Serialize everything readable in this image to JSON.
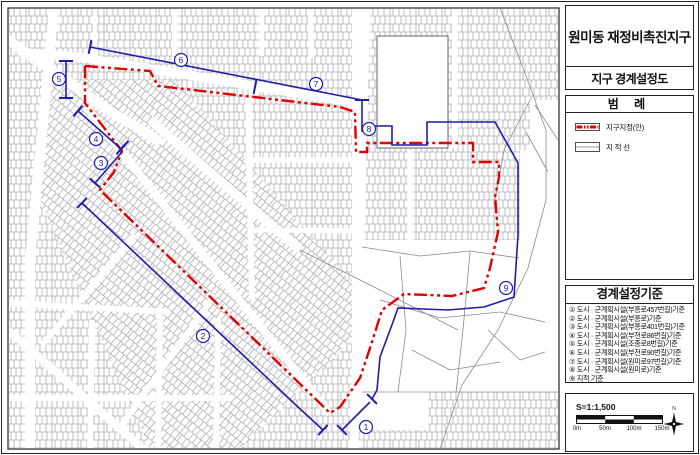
{
  "panel": {
    "title": "원미동 재정비촉진지구",
    "subtitle": "지구 경계설정도",
    "legend_title": "범 례",
    "legend_items": [
      {
        "label": "지구지정(안)",
        "type": "district-line"
      },
      {
        "label": "지 적 선",
        "type": "cadastral-line"
      }
    ]
  },
  "criteria": {
    "title": "경계설정기준",
    "items": [
      "① 도시 · 군계획시설(부흥로457번길)기준",
      "② 도시 · 군계획시설(부흥로)기준",
      "③ 도시 · 군계획시설(부흥로401번길)기준",
      "④ 도시 · 군계획시설(부천로86번길)기준",
      "⑤ 도시 · 군계획시설(조종로8번길)기준",
      "⑥ 도시 · 군계획시설(부천로90번길)기준",
      "⑦ 도시 · 군계획시설(원미로97번길)기준",
      "⑧ 도시 · 군계획시설(원미로)기준",
      "⑨ 지적 기준"
    ]
  },
  "scalebar": {
    "label": "S=1:1,500",
    "ticks": [
      "0m",
      "50m",
      "100m",
      "150m"
    ],
    "compass": "N"
  },
  "map": {
    "colors": {
      "district": "#e10000",
      "annotation": "#1d1daa",
      "parcel": "#8a8a96"
    },
    "red_boundary": [
      [
        85,
        66
      ],
      [
        150,
        71
      ],
      [
        158,
        86
      ],
      [
        340,
        107
      ],
      [
        355,
        112
      ],
      [
        356,
        152
      ],
      [
        367,
        152
      ],
      [
        367,
        143
      ],
      [
        473,
        143
      ],
      [
        473,
        162
      ],
      [
        499,
        162
      ],
      [
        499,
        177
      ],
      [
        495,
        197
      ],
      [
        498,
        232
      ],
      [
        490,
        268
      ],
      [
        484,
        288
      ],
      [
        452,
        296
      ],
      [
        404,
        294
      ],
      [
        382,
        310
      ],
      [
        372,
        342
      ],
      [
        360,
        378
      ],
      [
        340,
        407
      ],
      [
        330,
        413
      ],
      [
        100,
        190
      ],
      [
        114,
        172
      ],
      [
        122,
        151
      ],
      [
        85,
        103
      ],
      [
        85,
        66
      ]
    ],
    "blue_segments": [
      [
        [
          90,
          47
        ],
        [
          362,
          100
        ]
      ],
      [
        [
          66,
          61
        ],
        [
          66,
          98
        ]
      ],
      [
        [
          362,
          100
        ],
        [
          362,
          131
        ],
        [
          373,
          131
        ],
        [
          373,
          126
        ],
        [
          392,
          126
        ],
        [
          392,
          145
        ],
        [
          427,
          145
        ],
        [
          427,
          122
        ],
        [
          495,
          122
        ],
        [
          518,
          163
        ],
        [
          518,
          235
        ],
        [
          514,
          297
        ],
        [
          484,
          307
        ],
        [
          448,
          310
        ],
        [
          398,
          308
        ],
        [
          393,
          322
        ],
        [
          380,
          357
        ],
        [
          377,
          390
        ],
        [
          372,
          399
        ]
      ],
      [
        [
          370,
          402
        ],
        [
          342,
          430
        ]
      ],
      [
        [
          82,
          203
        ],
        [
          298,
          407
        ],
        [
          323,
          430
        ]
      ],
      [
        [
          78,
          111
        ],
        [
          120,
          148
        ]
      ],
      [
        [
          122,
          152
        ],
        [
          95,
          183
        ]
      ]
    ],
    "ticks": [
      [
        66,
        61,
        0
      ],
      [
        66,
        98,
        0
      ],
      [
        90,
        47,
        101
      ],
      [
        255,
        87,
        101
      ],
      [
        362,
        100,
        0
      ],
      [
        372,
        399,
        45
      ],
      [
        342,
        430,
        45
      ],
      [
        82,
        203,
        134
      ],
      [
        323,
        430,
        133
      ],
      [
        78,
        111,
        131
      ],
      [
        121,
        149,
        131
      ],
      [
        124,
        146,
        131
      ],
      [
        95,
        183,
        41
      ]
    ],
    "markers": [
      {
        "n": "1",
        "x": 366,
        "y": 427
      },
      {
        "n": "2",
        "x": 203,
        "y": 336
      },
      {
        "n": "3",
        "x": 101,
        "y": 163
      },
      {
        "n": "4",
        "x": 96,
        "y": 139
      },
      {
        "n": "5",
        "x": 59,
        "y": 79
      },
      {
        "n": "6",
        "x": 181,
        "y": 60
      },
      {
        "n": "7",
        "x": 316,
        "y": 84
      },
      {
        "n": "8",
        "x": 369,
        "y": 129
      },
      {
        "n": "9",
        "x": 506,
        "y": 288
      }
    ],
    "roads": [
      {
        "pts": [
          [
            54,
            8
          ],
          [
            30,
            260
          ],
          [
            30,
            449
          ]
        ],
        "w": 10
      },
      {
        "pts": [
          [
            366,
            8
          ],
          [
            354,
            449
          ]
        ],
        "w": 9
      },
      {
        "pts": [
          [
            20,
            52
          ],
          [
            85,
            58
          ],
          [
            362,
            104
          ]
        ],
        "w": 9
      },
      {
        "pts": [
          [
            86,
            107
          ],
          [
            330,
            414
          ]
        ],
        "w": 8
      },
      {
        "pts": [
          [
            8,
            40
          ],
          [
            105,
            108
          ],
          [
            160,
            142
          ]
        ],
        "w": 10
      },
      {
        "pts": [
          [
            150,
            120
          ],
          [
            300,
            250
          ]
        ],
        "w": 9
      },
      {
        "pts": [
          [
            8,
            330
          ],
          [
            150,
            455
          ]
        ],
        "w": 8
      },
      {
        "pts": [
          [
            135,
            235
          ],
          [
            42,
            345
          ]
        ],
        "w": 6
      },
      {
        "pts": [
          [
            215,
            295
          ],
          [
            118,
            430
          ]
        ],
        "w": 6
      },
      {
        "pts": [
          [
            8,
            303
          ],
          [
            170,
            312
          ]
        ],
        "w": 6
      },
      {
        "pts": [
          [
            175,
            8
          ],
          [
            175,
            56
          ]
        ],
        "w": 6
      },
      {
        "pts": [
          [
            262,
            8
          ],
          [
            262,
            56
          ]
        ],
        "w": 5
      },
      {
        "pts": [
          [
            310,
            8
          ],
          [
            312,
            58
          ]
        ],
        "w": 5
      },
      {
        "pts": [
          [
            95,
            8
          ],
          [
            95,
            56
          ]
        ],
        "w": 5
      },
      {
        "pts": [
          [
            455,
            8
          ],
          [
            455,
            148
          ]
        ],
        "w": 6
      },
      {
        "pts": [
          [
            410,
            150
          ],
          [
            410,
            240
          ]
        ],
        "w": 5
      },
      {
        "pts": [
          [
            248,
            95
          ],
          [
            252,
            300
          ]
        ],
        "w": 6
      },
      {
        "pts": [
          [
            250,
            160
          ],
          [
            352,
            160
          ]
        ],
        "w": 5
      },
      {
        "pts": [
          [
            250,
            230
          ],
          [
            352,
            231
          ]
        ],
        "w": 5
      },
      {
        "pts": [
          [
            8,
            398
          ],
          [
            230,
            398
          ]
        ],
        "w": 6
      },
      {
        "pts": [
          [
            92,
            320
          ],
          [
            90,
            449
          ]
        ],
        "w": 6
      },
      {
        "pts": [
          [
            160,
            315
          ],
          [
            158,
            449
          ]
        ],
        "w": 6
      },
      {
        "pts": [
          [
            218,
            318
          ],
          [
            216,
            449
          ]
        ],
        "w": 6
      }
    ],
    "open_lines": [
      [
        [
          500,
          8
        ],
        [
          520,
          60
        ],
        [
          546,
          130
        ],
        [
          546,
          200
        ],
        [
          528,
          268
        ],
        [
          498,
          330
        ],
        [
          462,
          385
        ],
        [
          440,
          449
        ]
      ],
      [
        [
          530,
          100
        ],
        [
          504,
          150
        ],
        [
          494,
          205
        ]
      ],
      [
        [
          362,
          247
        ],
        [
          420,
          256
        ],
        [
          470,
          251
        ],
        [
          519,
          258
        ]
      ],
      [
        [
          380,
          300
        ],
        [
          440,
          318
        ],
        [
          500,
          312
        ],
        [
          545,
          322
        ]
      ],
      [
        [
          400,
          256
        ],
        [
          406,
          330
        ],
        [
          398,
          392
        ]
      ],
      [
        [
          470,
          252
        ],
        [
          463,
          330
        ],
        [
          456,
          392
        ]
      ],
      [
        [
          300,
          250
        ],
        [
          380,
          290
        ],
        [
          458,
          330
        ]
      ],
      [
        [
          535,
          105
        ],
        [
          558,
          140
        ]
      ],
      [
        [
          526,
          132
        ],
        [
          548,
          172
        ]
      ],
      [
        [
          362,
          392
        ],
        [
          558,
          392
        ]
      ],
      [
        [
          488,
          330
        ],
        [
          520,
          360
        ],
        [
          545,
          352
        ]
      ],
      [
        [
          412,
          350
        ],
        [
          450,
          370
        ],
        [
          500,
          362
        ]
      ]
    ]
  }
}
